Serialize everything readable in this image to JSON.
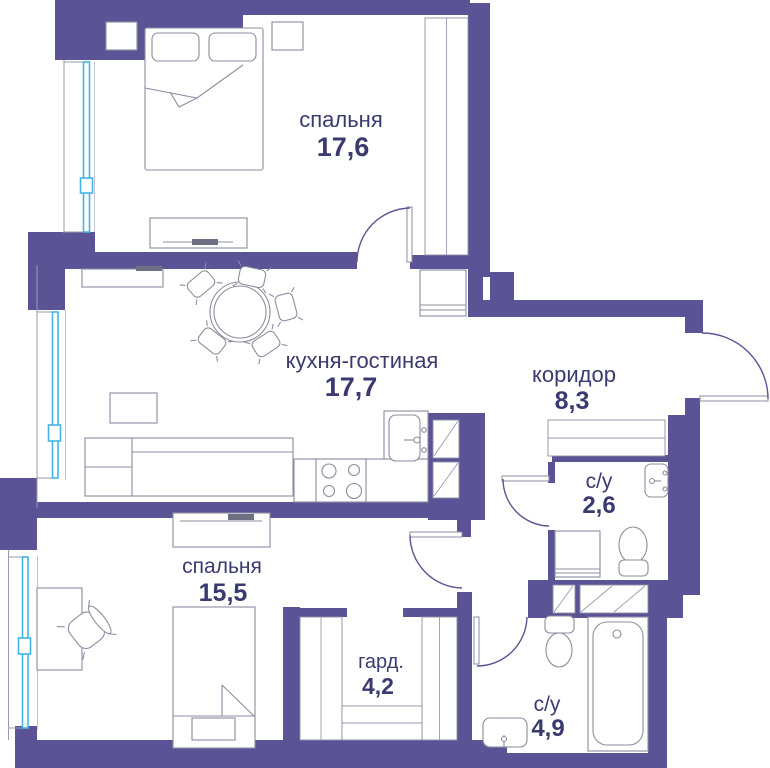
{
  "plan": {
    "rooms": [
      {
        "id": "bedroom-top",
        "name": "спальня",
        "area": "17,6"
      },
      {
        "id": "kitchen-living",
        "name": "кухня-гостиная",
        "area": "17,7"
      },
      {
        "id": "corridor",
        "name": "коридор",
        "area": "8,3"
      },
      {
        "id": "bathroom-small",
        "name": "с/у",
        "area": "2,6"
      },
      {
        "id": "bedroom-bottom",
        "name": "спальня",
        "area": "15,5"
      },
      {
        "id": "wardrobe",
        "name": "гард.",
        "area": "4,2"
      },
      {
        "id": "bathroom-large",
        "name": "с/у",
        "area": "4,9"
      }
    ],
    "colors": {
      "wall": "#5a5496",
      "window": "#45b4e4",
      "label_text": "#3a3a70",
      "furniture_line": "#8d8da1"
    }
  }
}
